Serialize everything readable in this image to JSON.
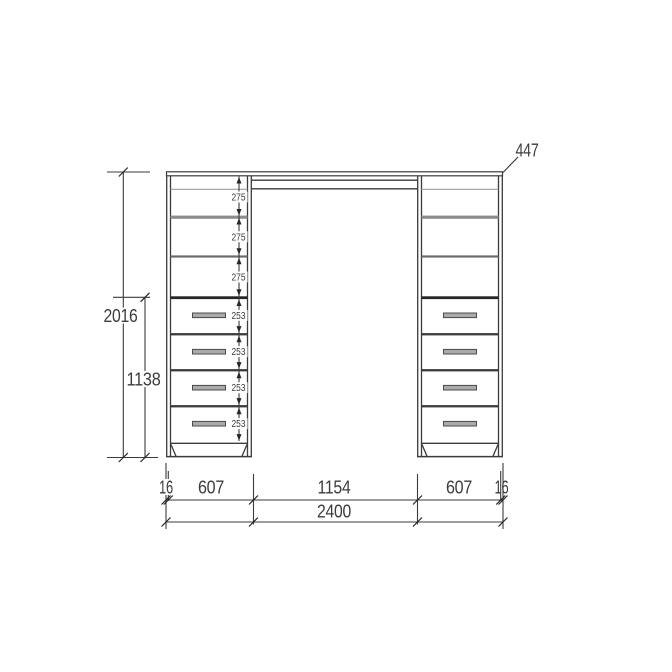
{
  "colors": {
    "bg": "#ffffff",
    "line": "#3b3b3b",
    "line_dark": "#262626",
    "line_light": "#9e9e9e",
    "shelf": "#8d8d8d",
    "shelf_dark": "#6a6a6a",
    "handle_fill": "#ababab",
    "handle_border": "#4b4b4b",
    "text": "#3c3c3c"
  },
  "dimensions": {
    "total_height_mm": "2016",
    "drawer_section_height_mm": "1138",
    "depth_mm": "447",
    "total_width_mm": "2400",
    "side_panel_left_mm": "16",
    "left_bay_mm": "607",
    "middle_bay_mm": "1154",
    "right_bay_mm": "607",
    "side_panel_right_mm": "16",
    "shelf_gaps_mm": [
      "275",
      "275",
      "275"
    ],
    "drawer_gaps_mm": [
      "253",
      "253",
      "253",
      "253"
    ]
  }
}
